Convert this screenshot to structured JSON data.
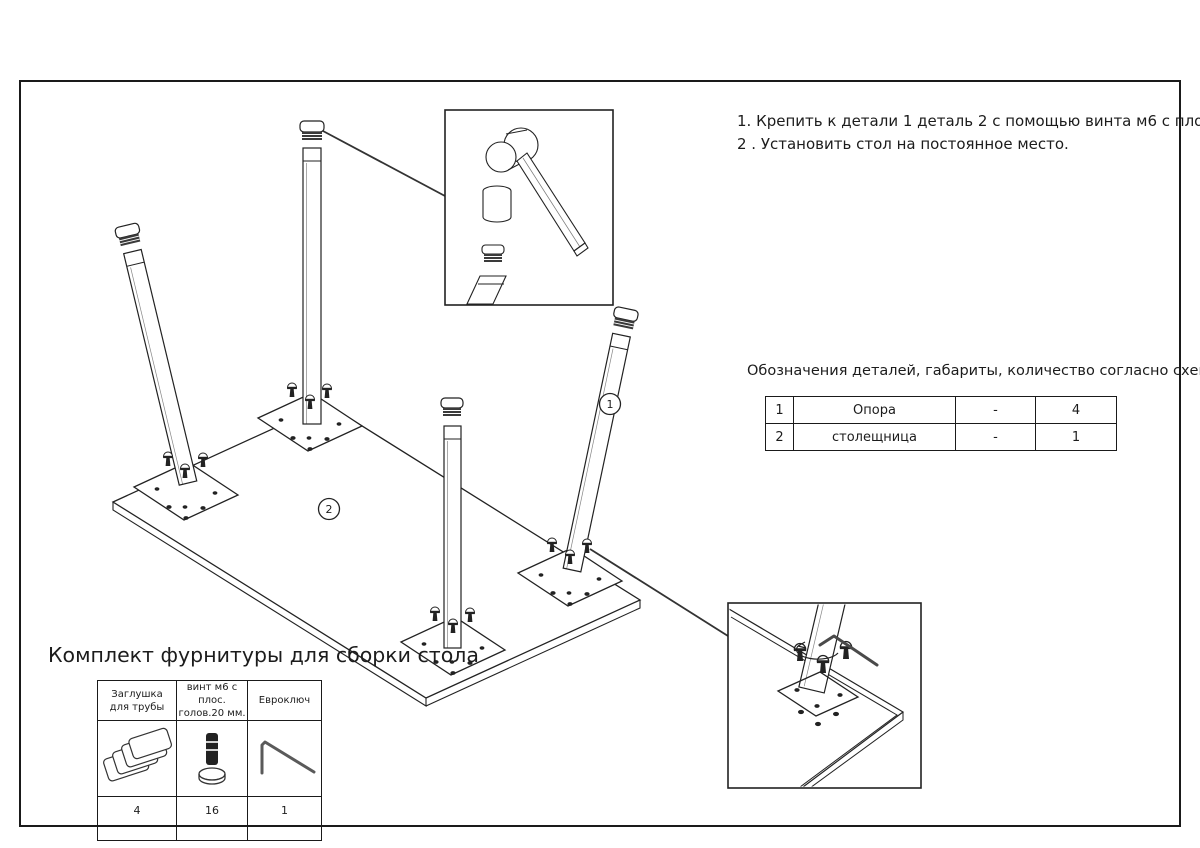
{
  "instructions": {
    "line1": "1. Крепить к детали 1 деталь 2 с помощью винта м6 с плос. голов.20 мм.",
    "line2": "2 . Установить стол на постоянное место."
  },
  "parts_table": {
    "heading": "Обозначения деталей, габариты, количество согласно схемы сборки",
    "rows": [
      {
        "num": "1",
        "name": "Опора",
        "size": "-",
        "qty": "4"
      },
      {
        "num": "2",
        "name": "столещница",
        "size": "-",
        "qty": "1"
      }
    ]
  },
  "hardware_kit": {
    "title": "Комплект фурнитуры для сборки стола",
    "items": [
      {
        "label_line1": "Заглушка",
        "label_line2": "для трубы",
        "icon": "tube-cap-icon",
        "qty": "4"
      },
      {
        "label_line1": "винт м6 с плос.",
        "label_line2": "голов.20 мм.",
        "icon": "screw-icon",
        "qty": "16"
      },
      {
        "label_line1": "Евроключ",
        "label_line2": "",
        "icon": "hex-key-icon",
        "qty": "1"
      }
    ]
  },
  "diagram": {
    "labels": [
      {
        "text": "1"
      },
      {
        "text": "2"
      }
    ],
    "line_color": "#222222"
  }
}
